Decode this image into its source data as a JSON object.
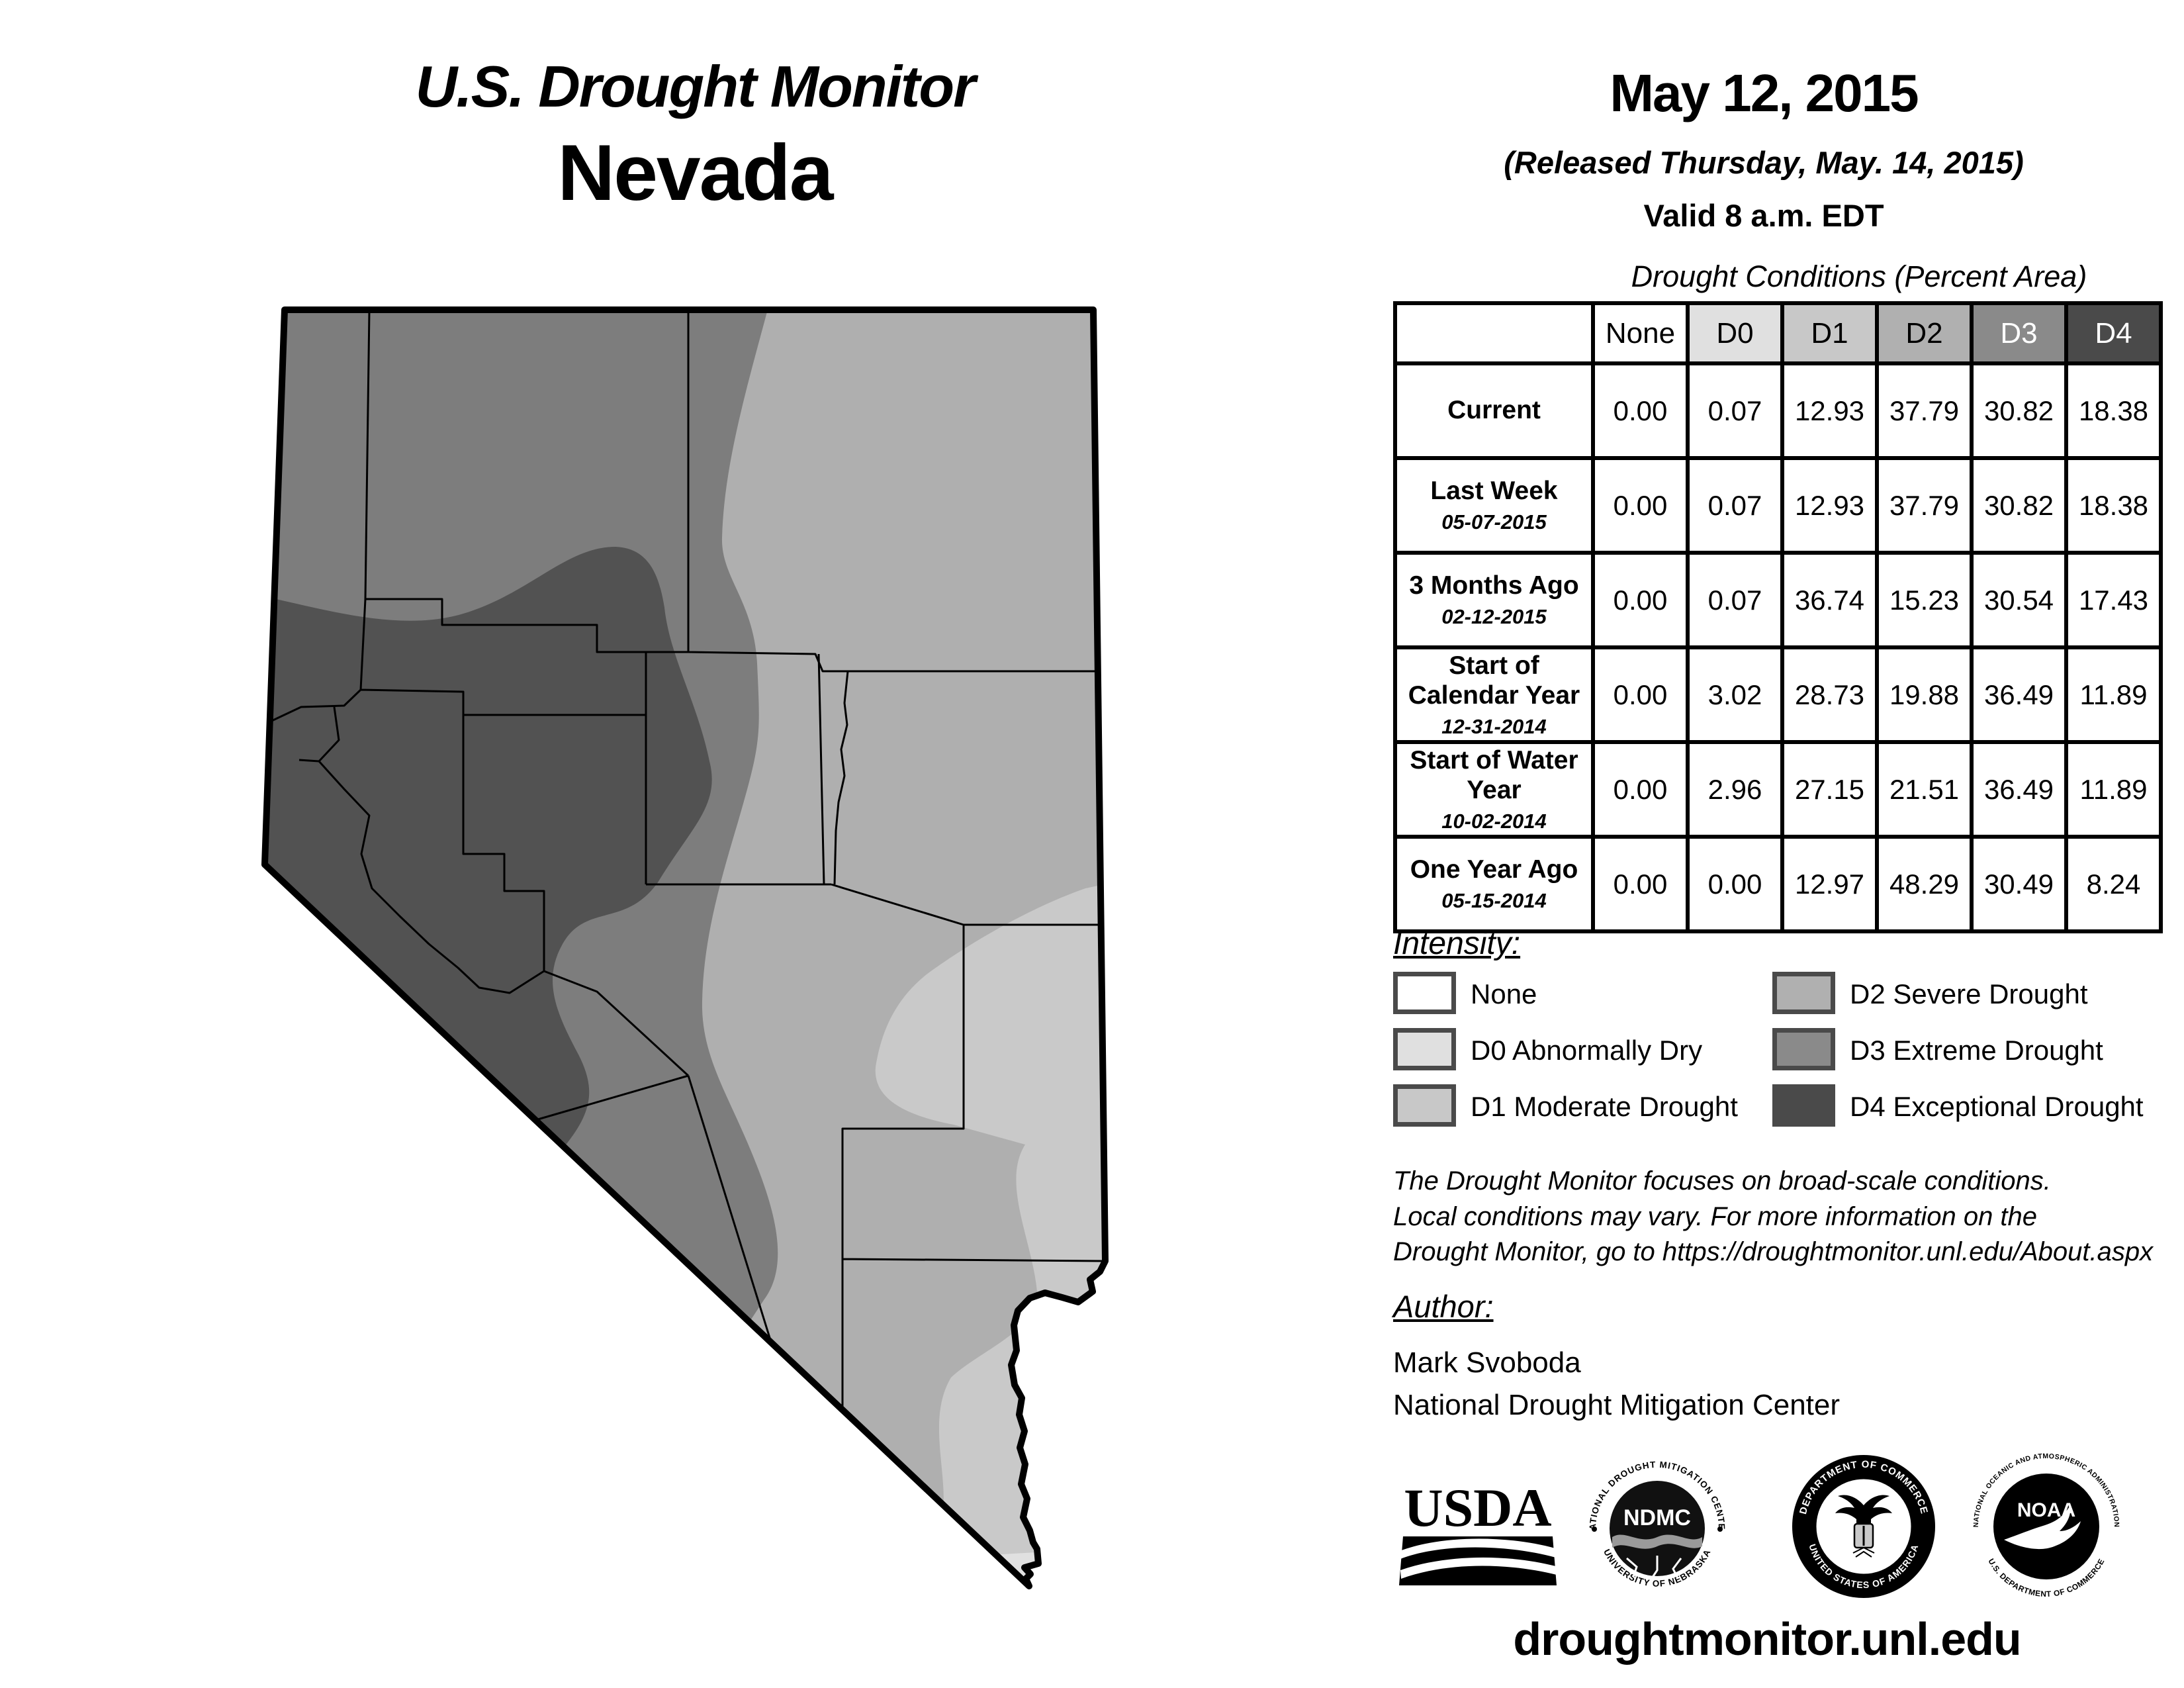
{
  "titles": {
    "main": "U.S. Drought Monitor",
    "region": "Nevada"
  },
  "date_block": {
    "date": "May 12, 2015",
    "released": "(Released Thursday, May. 14, 2015)",
    "valid": "Valid 8 a.m. EDT"
  },
  "table": {
    "title": "Drought Conditions (Percent Area)",
    "columns": [
      "None",
      "D0",
      "D1",
      "D2",
      "D3",
      "D4"
    ],
    "rows": [
      {
        "label": "Current",
        "sub": "",
        "values": [
          "0.00",
          "0.07",
          "12.93",
          "37.79",
          "30.82",
          "18.38"
        ]
      },
      {
        "label": "Last Week",
        "sub": "05-07-2015",
        "values": [
          "0.00",
          "0.07",
          "12.93",
          "37.79",
          "30.82",
          "18.38"
        ]
      },
      {
        "label": "3 Months Ago",
        "sub": "02-12-2015",
        "values": [
          "0.00",
          "0.07",
          "36.74",
          "15.23",
          "30.54",
          "17.43"
        ]
      },
      {
        "label": "Start of Calendar Year",
        "sub": "12-31-2014",
        "values": [
          "0.00",
          "3.02",
          "28.73",
          "19.88",
          "36.49",
          "11.89"
        ]
      },
      {
        "label": "Start of Water Year",
        "sub": "10-02-2014",
        "values": [
          "0.00",
          "2.96",
          "27.15",
          "21.51",
          "36.49",
          "11.89"
        ]
      },
      {
        "label": "One Year Ago",
        "sub": "05-15-2014",
        "values": [
          "0.00",
          "0.00",
          "12.97",
          "48.29",
          "30.49",
          "8.24"
        ]
      }
    ]
  },
  "legend": {
    "title": "Intensity:",
    "items": [
      {
        "label": "None",
        "color": "#ffffff"
      },
      {
        "label": "D0 Abnormally Dry",
        "color": "#e0e0e0"
      },
      {
        "label": "D1 Moderate Drought",
        "color": "#c8c8c8"
      },
      {
        "label": "D2 Severe Drought",
        "color": "#b0b0b0"
      },
      {
        "label": "D3 Extreme Drought",
        "color": "#8a8a8a"
      },
      {
        "label": "D4 Exceptional Drought",
        "color": "#4a4a4a"
      }
    ]
  },
  "disclaimer": {
    "lines": [
      "The Drought Monitor focuses on broad-scale conditions.",
      "Local conditions may vary. For more information on the",
      "Drought Monitor, go to https://droughtmonitor.unl.edu/About.aspx"
    ]
  },
  "author": {
    "heading": "Author:",
    "name": "Mark Svoboda",
    "org": "National Drought Mitigation Center"
  },
  "logos": {
    "usda": {
      "text": "USDA"
    },
    "ndmc": {
      "top": "NATIONAL DROUGHT MITIGATION CENTER",
      "center": "NDMC",
      "bottom": "UNIVERSITY OF NEBRASKA"
    },
    "commerce": {
      "top": "DEPARTMENT OF COMMERCE",
      "bottom": "UNITED STATES OF AMERICA"
    },
    "noaa": {
      "top": "NATIONAL OCEANIC AND ATMOSPHERIC ADMINISTRATION",
      "center": "NOAA",
      "bottom": "U.S. DEPARTMENT OF COMMERCE"
    }
  },
  "footer": {
    "url": "droughtmonitor.unl.edu"
  },
  "map": {
    "state": "Nevada",
    "colors": {
      "none": "#ffffff",
      "d0": "#e0e0e0",
      "d1": "#c9c9c9",
      "d2": "#afafaf",
      "d3": "#7d7d7d",
      "d4": "#525252"
    }
  }
}
